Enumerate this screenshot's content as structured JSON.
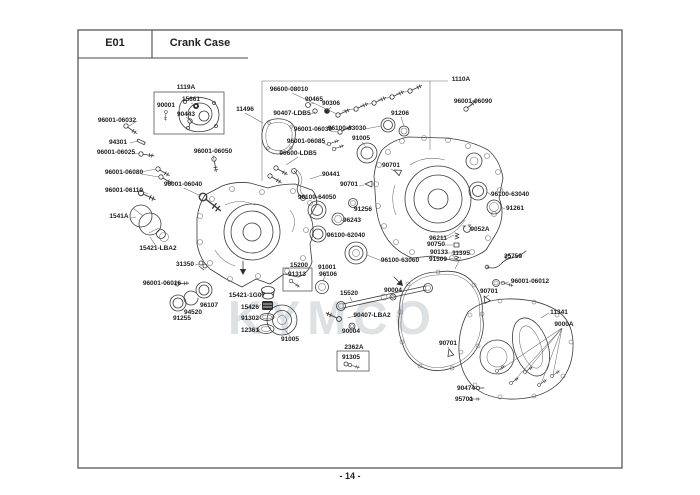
{
  "header": {
    "code": "E01",
    "title": "Crank Case"
  },
  "footer": {
    "page": "- 14 -"
  },
  "watermark": "KYMCO",
  "diagram": {
    "labels": [
      {
        "text": "1119A",
        "x": 186,
        "y": 89
      },
      {
        "text": "15661",
        "x": 191,
        "y": 101
      },
      {
        "text": "90001",
        "x": 166,
        "y": 107
      },
      {
        "text": "90443",
        "x": 186,
        "y": 116
      },
      {
        "text": "11496",
        "x": 245,
        "y": 111
      },
      {
        "text": "96001-06050",
        "x": 213,
        "y": 153
      },
      {
        "text": "96001-06032",
        "x": 117,
        "y": 122
      },
      {
        "text": "94301",
        "x": 118,
        "y": 144
      },
      {
        "text": "96001-06025",
        "x": 116,
        "y": 154
      },
      {
        "text": "96001-06080",
        "x": 124,
        "y": 174
      },
      {
        "text": "96001-06110",
        "x": 124,
        "y": 192
      },
      {
        "text": "96001-06040",
        "x": 183,
        "y": 186
      },
      {
        "text": "1541A",
        "x": 119,
        "y": 218
      },
      {
        "text": "15421-LBA2",
        "x": 158,
        "y": 250
      },
      {
        "text": "31350",
        "x": 185,
        "y": 266
      },
      {
        "text": "96001-06016",
        "x": 162,
        "y": 285
      },
      {
        "text": "96107",
        "x": 209,
        "y": 307
      },
      {
        "text": "94520",
        "x": 193,
        "y": 314
      },
      {
        "text": "91255",
        "x": 182,
        "y": 320
      },
      {
        "text": "96600-08010",
        "x": 289,
        "y": 91
      },
      {
        "text": "90465",
        "x": 314,
        "y": 101
      },
      {
        "text": "90306",
        "x": 331,
        "y": 105
      },
      {
        "text": "90407-LDB5",
        "x": 292,
        "y": 115
      },
      {
        "text": "96001-06030",
        "x": 313,
        "y": 131
      },
      {
        "text": "96001-06085",
        "x": 306,
        "y": 143
      },
      {
        "text": "96600-LDB5",
        "x": 298,
        "y": 155
      },
      {
        "text": "96100-63030",
        "x": 347,
        "y": 130
      },
      {
        "text": "91005",
        "x": 361,
        "y": 140
      },
      {
        "text": "91206",
        "x": 400,
        "y": 115
      },
      {
        "text": "90441",
        "x": 331,
        "y": 176
      },
      {
        "text": "90701",
        "x": 391,
        "y": 167
      },
      {
        "text": "90701",
        "x": 349,
        "y": 186
      },
      {
        "text": "96100-64050",
        "x": 317,
        "y": 199
      },
      {
        "text": "91256",
        "x": 363,
        "y": 211
      },
      {
        "text": "96243",
        "x": 352,
        "y": 222
      },
      {
        "text": "96100-62040",
        "x": 346,
        "y": 237
      },
      {
        "text": "96100-63060",
        "x": 400,
        "y": 262
      },
      {
        "text": "1110A",
        "x": 461,
        "y": 81
      },
      {
        "text": "96001-06090",
        "x": 473,
        "y": 103
      },
      {
        "text": "96100-63040",
        "x": 510,
        "y": 196
      },
      {
        "text": "91261",
        "x": 515,
        "y": 210
      },
      {
        "text": "9052A",
        "x": 480,
        "y": 231
      },
      {
        "text": "96211",
        "x": 438,
        "y": 240
      },
      {
        "text": "90750",
        "x": 436,
        "y": 246
      },
      {
        "text": "90133",
        "x": 439,
        "y": 254
      },
      {
        "text": "91509",
        "x": 438,
        "y": 261
      },
      {
        "text": "11395",
        "x": 461,
        "y": 255
      },
      {
        "text": "35759",
        "x": 513,
        "y": 258
      },
      {
        "text": "96001-06012",
        "x": 530,
        "y": 283
      },
      {
        "text": "90701",
        "x": 489,
        "y": 293
      },
      {
        "text": "11341",
        "x": 559,
        "y": 314
      },
      {
        "text": "9000A",
        "x": 564,
        "y": 326
      },
      {
        "text": "90701",
        "x": 448,
        "y": 345
      },
      {
        "text": "90474",
        "x": 466,
        "y": 390
      },
      {
        "text": "95701",
        "x": 464,
        "y": 401
      },
      {
        "text": "15200",
        "x": 299,
        "y": 267
      },
      {
        "text": "91313",
        "x": 297,
        "y": 276
      },
      {
        "text": "91001",
        "x": 327,
        "y": 269
      },
      {
        "text": "96106",
        "x": 328,
        "y": 276
      },
      {
        "text": "15421-1G07",
        "x": 247,
        "y": 297
      },
      {
        "text": "15426",
        "x": 250,
        "y": 309
      },
      {
        "text": "91302",
        "x": 250,
        "y": 320
      },
      {
        "text": "12361",
        "x": 250,
        "y": 332
      },
      {
        "text": "91005",
        "x": 290,
        "y": 341
      },
      {
        "text": "15520",
        "x": 349,
        "y": 295
      },
      {
        "text": "90004",
        "x": 393,
        "y": 292
      },
      {
        "text": "90407-LBA2",
        "x": 372,
        "y": 317
      },
      {
        "text": "90004",
        "x": 351,
        "y": 333
      },
      {
        "text": "2362A",
        "x": 354,
        "y": 349
      },
      {
        "text": "91305",
        "x": 351,
        "y": 359
      }
    ]
  }
}
